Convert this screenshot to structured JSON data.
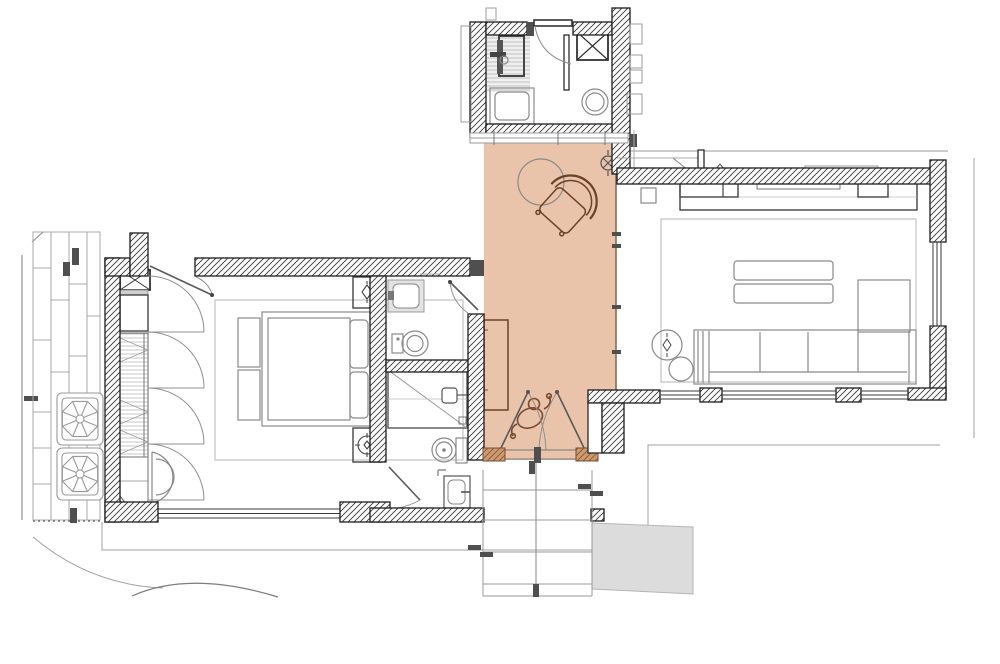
{
  "title": "apartment-floor-plan",
  "colors": {
    "highlight": "#e9c4ab",
    "highlight_edge": "#8f6a52",
    "wall_line": "#1c1c1c",
    "furniture_gray": "#8a8a8a",
    "furniture_dark": "#444444",
    "brown": "#6b4226",
    "threshold_brown": "#cd9b72",
    "gray_area": "#dcdcdc",
    "jamb": "#4f4f4f",
    "site_line": "#a0a0a0"
  },
  "rooms": [
    {
      "id": "utility-shower-room",
      "position": "top-center",
      "features": [
        "shower-with-column",
        "wall-hung-unit-x-box",
        "boiler-circle",
        "counter-basin",
        "swing-door"
      ]
    },
    {
      "id": "entry-hall",
      "position": "center",
      "highlighted": true,
      "features": [
        "round-side-table",
        "armchair",
        "ceiling-light-symbol",
        "wall-console",
        "person-figure",
        "double-entry-door",
        "wall-socket-diamonds"
      ]
    },
    {
      "id": "guest-bathroom",
      "position": "center-left-upper",
      "features": [
        "vanity-washbasin",
        "bidet",
        "swing-door"
      ]
    },
    {
      "id": "master-bathroom",
      "position": "center-left-lower",
      "features": [
        "walk-in-shower",
        "toilet",
        "washbasin",
        "swing-door",
        "small-window"
      ]
    },
    {
      "id": "bedroom",
      "position": "left",
      "features": [
        "double-bed",
        "mattress",
        "pillows",
        "nightstand-with-lamp-x2",
        "bench-x2",
        "rug",
        "wardrobe-4-doors",
        "safe-x-box",
        "reading-chair",
        "window-band",
        "swing-door"
      ]
    },
    {
      "id": "living-room",
      "position": "right",
      "features": [
        "sideboard",
        "tv",
        "rug",
        "coffee-table-x2",
        "sofa-4-seat",
        "chaise",
        "round-side-table-x2",
        "window-band-bottom",
        "window-right",
        "vestibule-door"
      ]
    },
    {
      "id": "exterior",
      "position": "around",
      "features": [
        "entry-steps",
        "gray-ramp",
        "terrace-outline",
        "timber-cladding",
        "ac-unit-x2",
        "ground-curves",
        "property-line",
        "dotted-boundary"
      ]
    }
  ]
}
